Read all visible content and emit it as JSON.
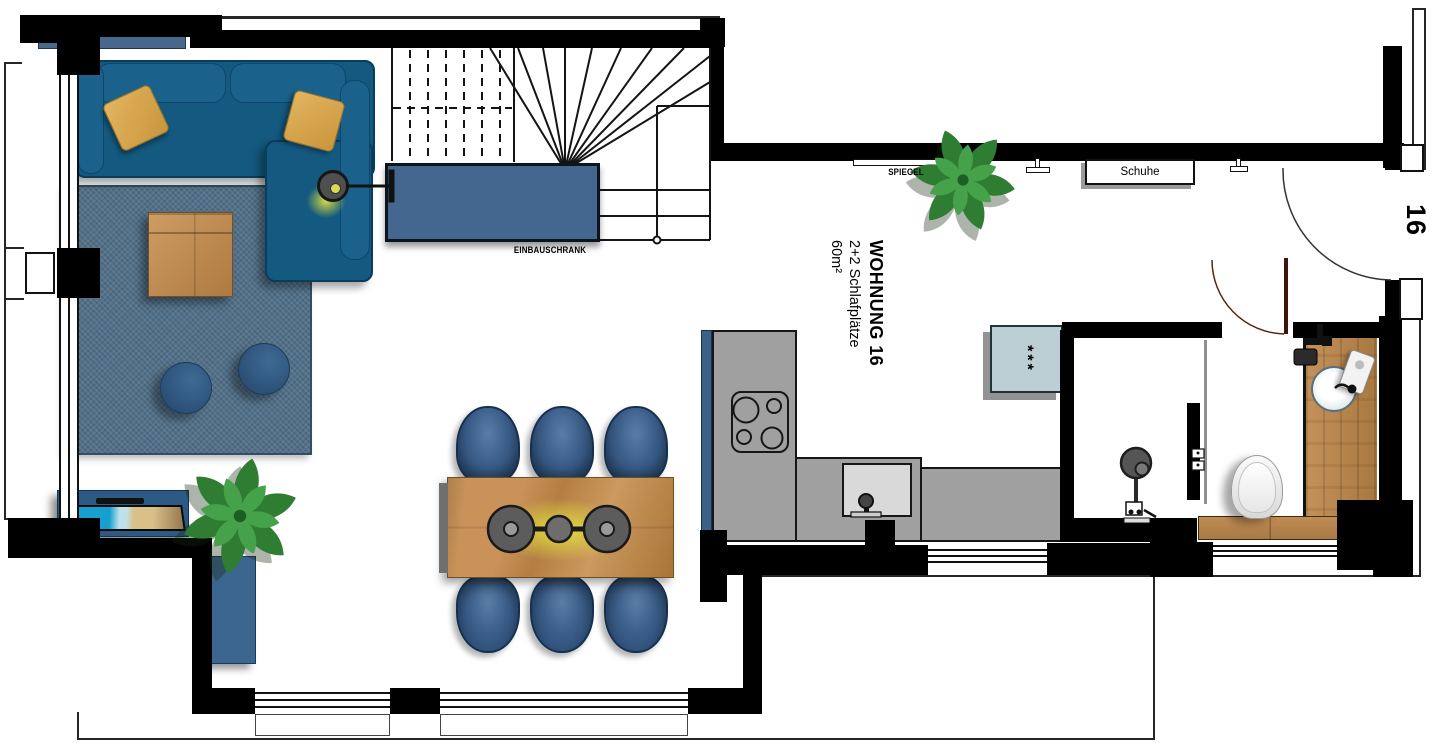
{
  "floorplan": {
    "unit": {
      "title": "WOHNUNG 16",
      "capacity": "2+2 Schlafplätze",
      "area": "60m²",
      "door_number": "16"
    },
    "labels": {
      "built_in_wardrobe": "EINBAUSCHRANK",
      "mirror": "SPIEGEL",
      "shoe_cabinet": "Schuhe",
      "appliance_symbol": "***"
    },
    "colors": {
      "wall": "#000000",
      "sofa_blue": "#14597f",
      "cabinet_blue": "#44678f",
      "rug_blue": "#517089",
      "wood": "#bf8d55",
      "counter_gray": "#a0a0a0",
      "pillow_gold": "#d8a851",
      "plant_green": "#2e7d33",
      "appliance_teal": "#bccfd4",
      "lamp_glow": "#e6e93c",
      "bath_door_red": "#5a2616"
    }
  }
}
